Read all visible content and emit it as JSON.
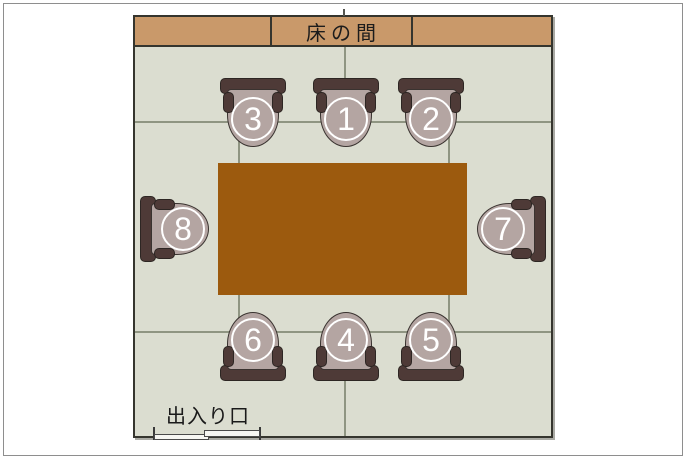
{
  "diagram": {
    "tokonoma_label": "床の間",
    "entrance_label": "出入り口"
  },
  "seats": [
    {
      "number": "1"
    },
    {
      "number": "2"
    },
    {
      "number": "3"
    },
    {
      "number": "4"
    },
    {
      "number": "5"
    },
    {
      "number": "6"
    },
    {
      "number": "7"
    },
    {
      "number": "8"
    }
  ],
  "colors": {
    "floor": "#dbddd0",
    "wall": "#35352e",
    "tokonoma_band": "#c9996a",
    "table": "#9c5a0e",
    "chair_frame": "#4e3a37",
    "chair_seat": "#b4a5a2",
    "tatami_line": "#8f9582",
    "number_badge": "#ffffff"
  }
}
